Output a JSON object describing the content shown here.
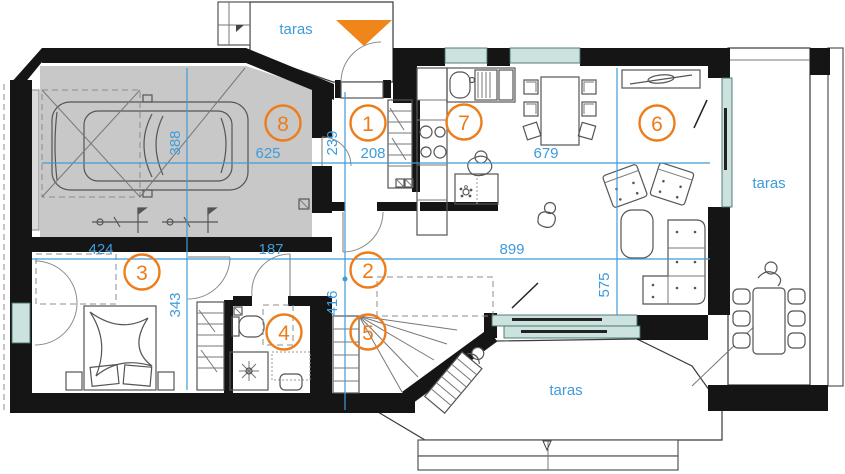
{
  "plan_type": "floor-plan",
  "colors": {
    "accent_orange": "#ed7d1b",
    "dimension_blue": "#3f9bd9",
    "wall_black": "#151515",
    "garage_floor_gray": "#c8c8c8",
    "glass_teal": "#cbe2df",
    "hatch_gray": "#9a9a9a"
  },
  "rooms": [
    {
      "number": "1"
    },
    {
      "number": "2"
    },
    {
      "number": "3"
    },
    {
      "number": "4"
    },
    {
      "number": "5"
    },
    {
      "number": "6"
    },
    {
      "number": "7"
    },
    {
      "number": "8"
    }
  ],
  "dimensions": {
    "d625": "625",
    "d388": "388",
    "d239": "239",
    "d208": "208",
    "d679": "679",
    "d424": "424",
    "d187": "187",
    "d899": "899",
    "d343": "343",
    "d416": "416",
    "d575": "575"
  },
  "terraces": {
    "top": "taras",
    "right": "taras",
    "bottom": "taras"
  }
}
